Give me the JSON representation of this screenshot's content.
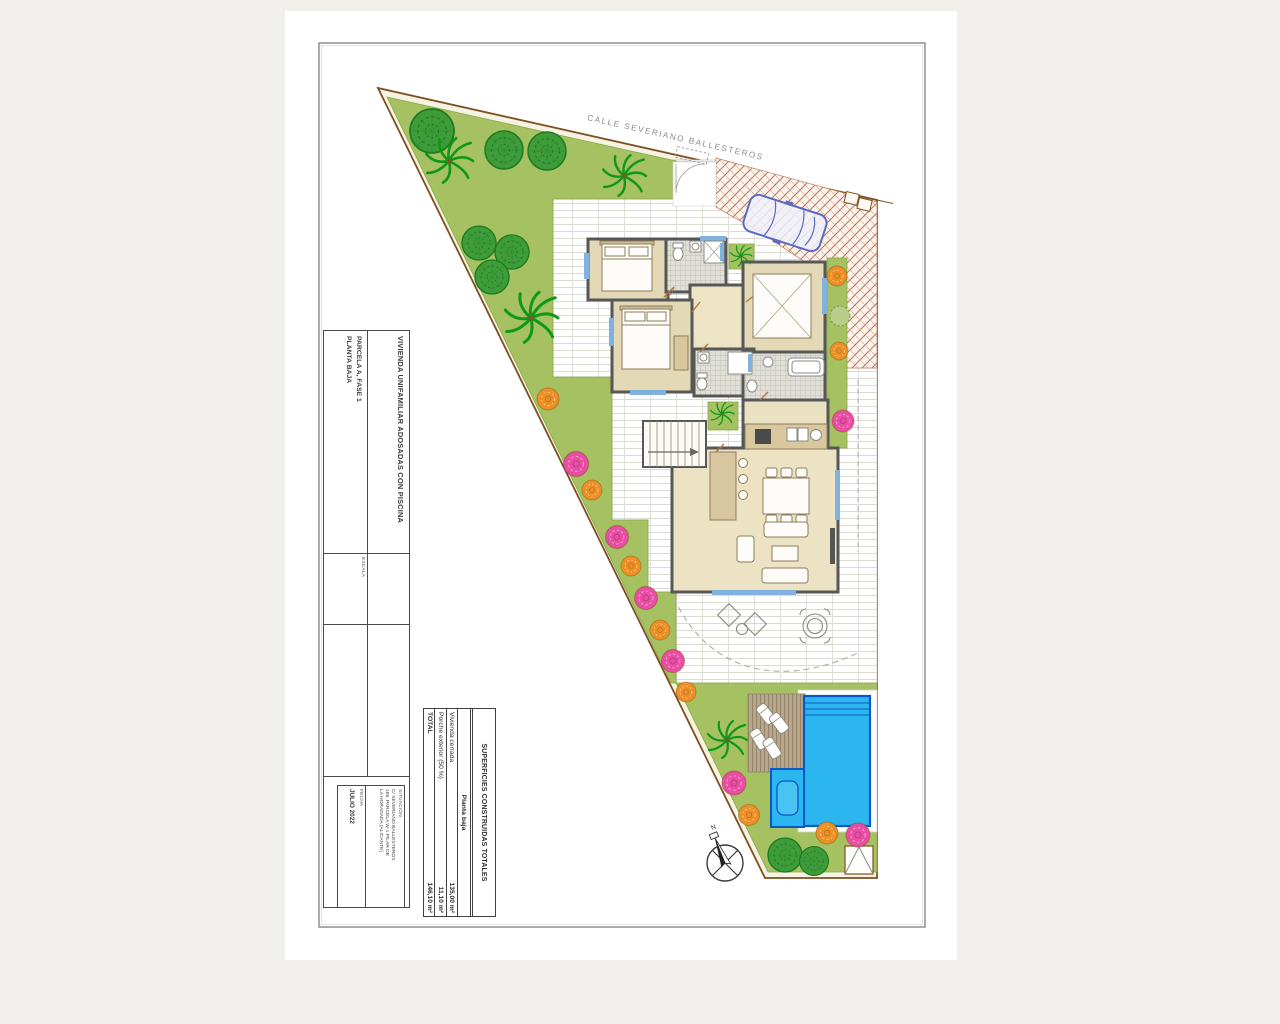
{
  "canvas": {
    "street_label": "CALLE SEVERIANO BALLESTEROS",
    "north_label": "N"
  },
  "title_block": {
    "project_title": "VIVIENDA UNIFAMILIAR ADOSADAS CON PISCINA",
    "parcel_line1": "PARCELA A, FASE 1",
    "parcel_line2": "PLANTA BAJA",
    "scale_label": "ESCALA",
    "location_label": "SITUACIÓN",
    "location_line1": "C/ SEVERIANO BALLESTEROS,",
    "location_line2": "186, PARCELA W-1 PILAR DE",
    "location_line3": "LA HORADADA (ALICANTE)",
    "date_label": "FECHA",
    "date_value": "JULIO 2022"
  },
  "areas_table": {
    "title": "SUPERFICIES CONSTRUIDAS TOTALES",
    "subtitle": "Planta baja",
    "rows": [
      {
        "label": "Vivienda cerrada",
        "value": "135,00 m²"
      },
      {
        "label": "Porche exterior (50 %)",
        "value": "11,10 m²"
      },
      {
        "label": "TOTAL",
        "value": "146,10 m²"
      }
    ]
  },
  "colors": {
    "page_background": "#f1efeb",
    "paper": "#ffffff",
    "plot_cream": "#f7f3e2",
    "boundary_brown": "#7d4f21",
    "garden_green": "#a6c162",
    "tree_green": "#3f9c3b",
    "palm_green": "#0f9718",
    "bush_orange": "#ec9026",
    "bush_pink": "#e94da4",
    "pool_blue": "#2cb6ef",
    "pool_line_blue": "#0a58c4",
    "deck_tan": "#b7a78c",
    "wall_gray": "#575757",
    "room_beige": "#e3d9b6",
    "herringbone_terracotta": "#c27a58",
    "car_blue": "#5b6bc0"
  }
}
